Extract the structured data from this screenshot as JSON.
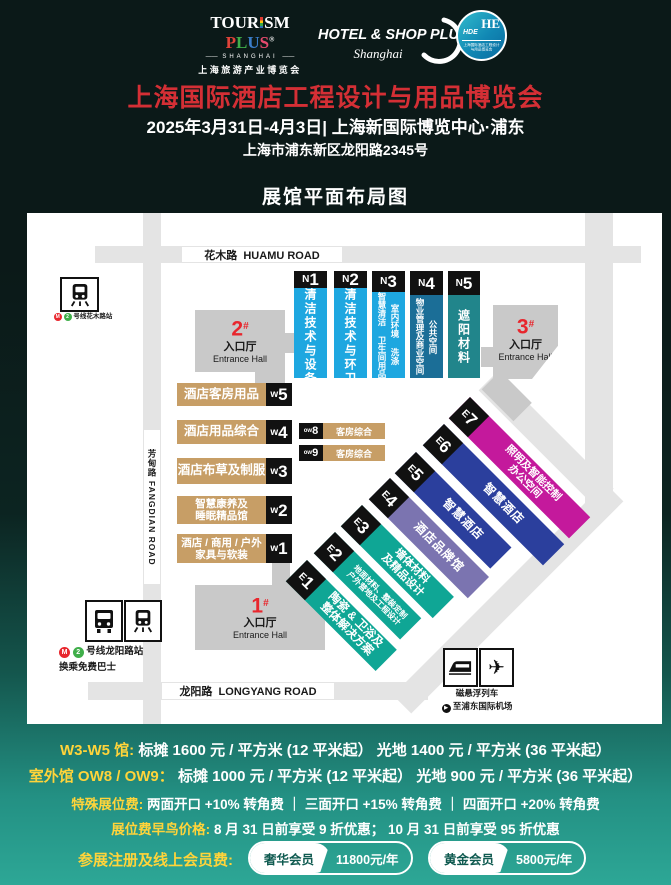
{
  "header": {
    "tourism_logo": {
      "word_a": "TOUR",
      "word_b": "SM",
      "plus_p": "P",
      "plus_l": "L",
      "plus_u": "U",
      "plus_s": "S",
      "reg": "®",
      "line2": "SHANGHAI",
      "line3": "上海旅游产业博览会"
    },
    "hotelshop_logo": {
      "line1": "HOTEL & SHOP PLUS",
      "line2": "Shanghai"
    },
    "hde_logo": {
      "monogram": "HE",
      "sub": "HDE",
      "tiny1": "上海国际酒店工程设计",
      "tiny2": "与用品博览会"
    },
    "title": "上海国际酒店工程设计与用品博览会",
    "date_line": "2025年3月31日-4月3日| 上海新国际博览中心·浦东",
    "address_line": "上海市浦东新区龙阳路2345号",
    "map_heading": "展馆平面布局图"
  },
  "map": {
    "roads": {
      "huamu": "花木路  HUAMU ROAD",
      "fangdian": "芳甸路 FANGDIAN ROAD",
      "longyang": "龙阳路  LONGYANG ROAD"
    },
    "transit": {
      "huamu_station": {
        "line": "2",
        "name": "号线花木路站"
      },
      "longyang_station": {
        "line": "2",
        "name": "号线龙阳路站",
        "note": "换乘免费巴士"
      },
      "maglev": "磁悬浮列车",
      "airport": "至浦东国际机场"
    },
    "entrances": [
      {
        "num": "1",
        "hash": "#",
        "label": "入口厅",
        "label_en": "Entrance Hall"
      },
      {
        "num": "2",
        "hash": "#",
        "label": "入口厅",
        "label_en": "Entrance Hall"
      },
      {
        "num": "3",
        "hash": "#",
        "label": "入口厅",
        "label_en": "Entrance Hall"
      }
    ],
    "n_halls": [
      {
        "prefix": "N",
        "num": "1",
        "text": "清洁技术与设备",
        "color": "#1ea7e0"
      },
      {
        "prefix": "N",
        "num": "2",
        "text": "清洁技术与环卫",
        "color": "#1ea7e0"
      },
      {
        "prefix": "N",
        "num": "3",
        "col_left": "智慧清洁 卫生间用品",
        "col_right": "室内环境 洗涤",
        "color": "#1ea7e0"
      },
      {
        "prefix": "N",
        "num": "4",
        "col_left": "物业管理及商业空间",
        "col_right": "公共空间",
        "color": "#1b6e97"
      },
      {
        "prefix": "N",
        "num": "5",
        "text": "遮阳材料",
        "color": "#21858b"
      }
    ],
    "w_halls": [
      {
        "prefix": "W",
        "num": "5",
        "line1": "酒店客房用品",
        "color": "#c79e66"
      },
      {
        "prefix": "W",
        "num": "4",
        "line1": "酒店用品综合",
        "color": "#c79e66"
      },
      {
        "prefix": "W",
        "num": "3",
        "line1": "酒店布草及制服",
        "color": "#c79e66"
      },
      {
        "prefix": "W",
        "num": "2",
        "line1": "智慧康养及",
        "line2": "睡眠精品馆",
        "color": "#c79e66"
      },
      {
        "prefix": "W",
        "num": "1",
        "line1": "酒店 / 商用 / 户外",
        "line2": "家具与软装",
        "color": "#c79e66"
      }
    ],
    "ow_halls": [
      {
        "prefix": "OW",
        "num": "8",
        "text": "客房综合",
        "color": "#c79e66"
      },
      {
        "prefix": "OW",
        "num": "9",
        "text": "客房综合",
        "color": "#c79e66"
      }
    ],
    "e_halls": [
      {
        "prefix": "E",
        "num": "1",
        "line1": "陶瓷 & 卫浴及",
        "line2": "整体解决方案",
        "color": "#0fa695"
      },
      {
        "prefix": "E",
        "num": "2",
        "line1": "地面材料、整装定制",
        "line2": "户外营地及工程设计",
        "color": "#0fa695"
      },
      {
        "prefix": "E",
        "num": "3",
        "line1": "墙体材料",
        "line2": "及精品设计",
        "color": "#0fa695"
      },
      {
        "prefix": "E",
        "num": "4",
        "line1": "酒店品牌馆",
        "color": "#7b74b0"
      },
      {
        "prefix": "E",
        "num": "5",
        "line1": "智慧酒店",
        "color": "#2b3f9d"
      },
      {
        "prefix": "E",
        "num": "6",
        "line1": "智慧酒店",
        "color": "#2b3f9d"
      },
      {
        "prefix": "E",
        "num": "7",
        "line1": "照明及智能控制",
        "line2": "办公空间",
        "color": "#c4199c"
      }
    ]
  },
  "pricing": {
    "line1": {
      "label": "W3-W5 馆:",
      "text": "标摊  1600 元 / 平方米 (12 平米起）  光地 1400 元 / 平方米 (36 平米起）"
    },
    "line2": {
      "label": "室外馆 OW8 / OW9：",
      "text": "标摊  1000 元 / 平方米 (12 平米起）  光地 900 元 / 平方米 (36 平米起）"
    },
    "line3": {
      "label": "特殊展位费:",
      "text": "两面开口 +10% 转角费 ｜ 三面开口 +15% 转角费 ｜ 四面开口 +20% 转角费"
    },
    "line4": {
      "label": "展位费早鸟价格:",
      "text": "8 月 31 日前享受 9 折优惠； 10 月 31 日前享受 95 折优惠"
    },
    "membership": {
      "label": "参展注册及线上会员费:",
      "members": [
        {
          "name": "奢华会员",
          "price": "11800元/年"
        },
        {
          "name": "黄金会员",
          "price": "5800元/年"
        }
      ]
    }
  },
  "colors": {
    "title_red": "#d42f35",
    "accent_red": "#e8262d",
    "yellow": "#ffd43a",
    "n_blue": "#1ea7e0",
    "n_steel": "#1b6e97",
    "n_teal": "#21858b",
    "w_tan": "#c79e66",
    "e_teal": "#0fa695",
    "e_purple": "#7b74b0",
    "e_blue": "#2b3f9d",
    "e_magenta": "#c4199c",
    "bg_teal": "#2da796"
  }
}
